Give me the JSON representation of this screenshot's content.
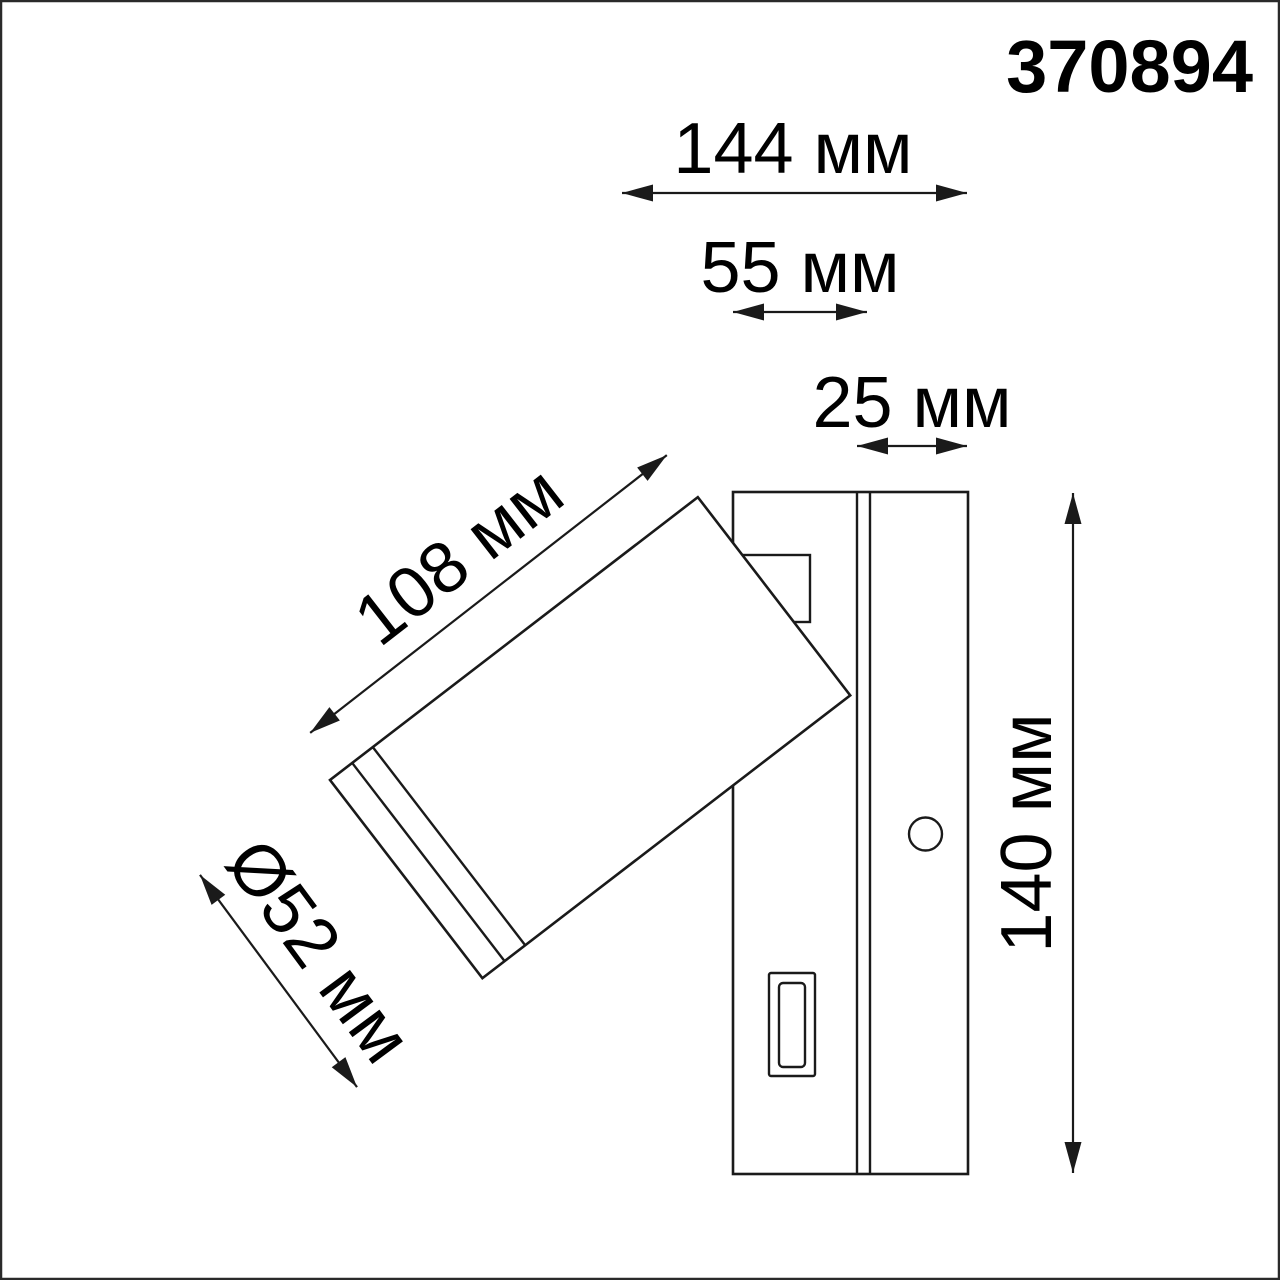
{
  "article_number": "370894",
  "colors": {
    "line": "#1a1a1a",
    "text": "#000000",
    "background": "#ffffff",
    "border": "#2a2a2a"
  },
  "dimensions": {
    "total_width": {
      "label": "144 мм",
      "value": 144,
      "unit": "мм"
    },
    "backplate_width": {
      "label": "55 мм",
      "value": 55,
      "unit": "мм"
    },
    "backplate_thickness": {
      "label": "25 мм",
      "value": 25,
      "unit": "мм"
    },
    "spot_length": {
      "label": "108 мм",
      "value": 108,
      "unit": "мм"
    },
    "spot_diameter": {
      "label": "Ø52 мм",
      "value": 52,
      "unit": "мм"
    },
    "height": {
      "label": "140 мм",
      "value": 140,
      "unit": "мм"
    }
  }
}
